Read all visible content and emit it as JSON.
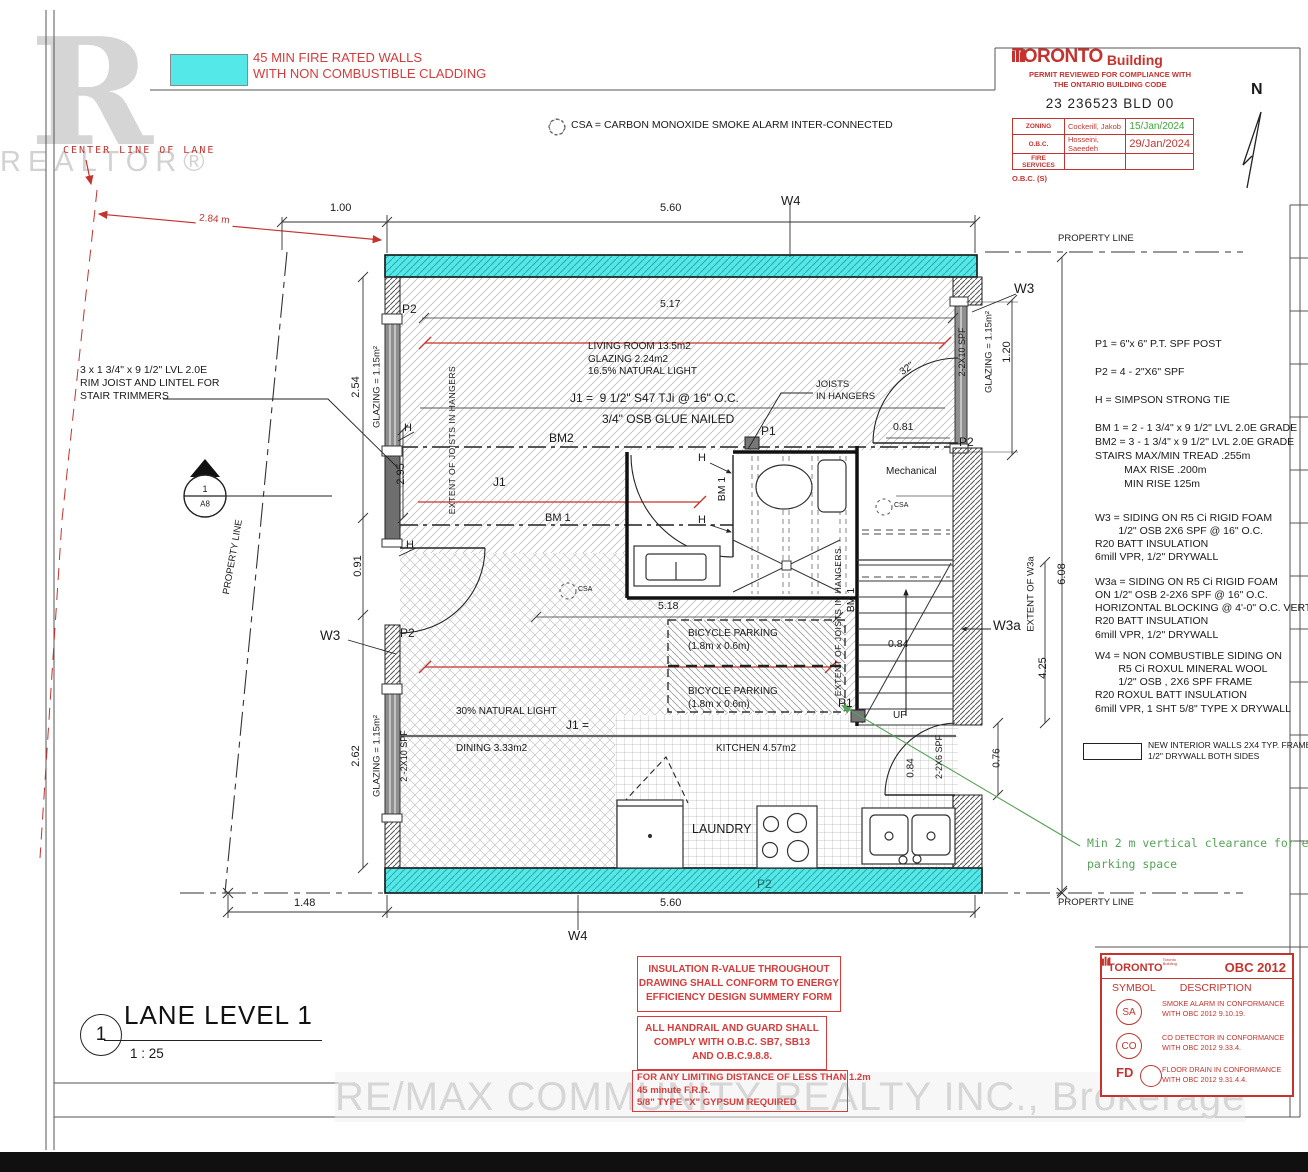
{
  "colors": {
    "fire_wall_cyan": "#55e8e8",
    "permit_red": "#c5332f",
    "note_red": "#d63c3c",
    "date_green": "#3aa83a",
    "annot_green": "#55a357"
  },
  "watermark": {
    "r": "R",
    "realtor": "REALTOR®",
    "brokerage": "RE/MAX COMMUNITY REALTY INC., Brokerage"
  },
  "fire_legend": "45 MIN FIRE RATED WALLS\nWITH NON COMBUSTIBLE CLADDING",
  "lane_centerline": "CENTER LINE OF LANE",
  "csa_note": "CSA = CARBON MONOXIDE SMOKE ALARM INTER-CONNECTED",
  "north_label": "N",
  "stamp": {
    "brand_toronto": "TORONTO",
    "brand_building": "Building",
    "subtitle": "PERMIT REVIEWED FOR COMPLIANCE WITH\nTHE ONTARIO BUILDING CODE",
    "permit_no": "23 236523 BLD 00",
    "rows": [
      {
        "label": "ZONING",
        "name": "Cockerill, Jakob",
        "date": "15/Jan/2024"
      },
      {
        "label": "O.B.C.",
        "name": "Hosseini, Saeedeh",
        "date": "29/Jan/2024"
      },
      {
        "label": "FIRE SERVICES",
        "name": "",
        "date": ""
      }
    ],
    "footer": "O.B.C. (S)"
  },
  "side_notes": {
    "posts": "P1 = 6\"x 6\" P.T. SPF POST\n\nP2 = 4 - 2\"X6\" SPF\n\nH = SIMPSON STRONG TIE\n\nBM 1 = 2 - 1 3/4\" x 9 1/2\" LVL 2.0E GRADE\nBM2 = 3 - 1 3/4\" x 9 1/2\" LVL 2.0E GRADE\nSTAIRS MAX/MIN TREAD .255m\n          MAX RISE .200m\n          MIN RISE 125m",
    "w3": "W3 = SIDING ON R5 Ci RIGID FOAM\n        1/2\" OSB 2X6 SPF @ 16\" O.C.\nR20 BATT INSULATION\n6mill VPR, 1/2\" DRYWALL",
    "w3a": "W3a = SIDING ON R5 Ci RIGID FOAM\nON 1/2\" OSB 2-2X6 SPF @ 16\" O.C.\nHORIZONTAL BLOCKING @ 4'-0\" O.C. VERTICAL\nR20 BATT INSULATION\n6mill VPR, 1/2\" DRYWALL",
    "w4": "W4 = NON COMBUSTIBLE SIDING ON\n        R5 Ci ROXUL MINERAL WOOL\n        1/2\" OSB , 2X6 SPF FRAME\nR20 ROXUL BATT INSULATION\n6mill VPR, 1 SHT 5/8\" TYPE X DRYWALL",
    "interior_walls": "NEW INTERIOR WALLS 2X4 TYP. FRAME\n1/2\" DRYWALL BOTH SIDES",
    "rim_joist": "3 x 1 3/4\" x 9 1/2\" LVL 2.0E\nRIM JOIST AND LINTEL FOR\nSTAIR TRIMMERS"
  },
  "rooms": {
    "living": "LIVING ROOM 13.5m2\nGLAZING 2.24m2\n16.5% NATURAL LIGHT",
    "mechanical": "Mechanical",
    "bicycle": "BICYCLE PARKING\n(1.8m x 0.6m)",
    "dining": "DINING 3.33m2",
    "kitchen": "KITCHEN 4.57m2",
    "laundry": "LAUNDRY",
    "natural_light": "30% NATURAL LIGHT",
    "up": "UP"
  },
  "structure": {
    "j1_spec": "J1 =  9 1/2\" S47 TJi @ 16\" O.C.",
    "osb": "3/4\" OSB GLUE NAILED",
    "bm2": "BM2",
    "bm1": "BM 1",
    "j1": "J1",
    "j1_eq": "J1 =",
    "joists_in_hangers": "JOISTS\nIN HANGERS",
    "extent_joists": "EXTENT OF JOISTS IN HANGERS",
    "extent_w3a": "EXTENT OF W3a",
    "csa": "CSA",
    "p1": "P1",
    "p2": "P2",
    "h": "H",
    "w3": "W3",
    "w3a": "W3a",
    "w4": "W4",
    "spf_2x10": "2-2X10 SPF",
    "spf_2x10_sp": "2 -2X10 SPF",
    "spf_2x6": "2-2X6 SPF",
    "door_32": "32\""
  },
  "dims": {
    "d100": "1.00",
    "d560": "5.60",
    "d284": "2.84 m",
    "d517": "5.17",
    "d518": "5.18",
    "d254": "2.54",
    "d295": "2.95",
    "d091": "0.91",
    "d262": "2.62",
    "d148": "1.48",
    "d081": "0.81",
    "d084": "0.84",
    "d120": "1.20",
    "d425": "4.25",
    "d608": "6.08",
    "d076": "0.76",
    "glazing": "GLAZING = 1.15m²"
  },
  "boundaries": {
    "property_line": "PROPERTY LINE"
  },
  "section_marker": {
    "num": "1",
    "sheet": "A8"
  },
  "green_note": "Min 2 m vertical clearance for each\nparking space",
  "red_notes": {
    "insulation": "INSULATION R-VALUE THROUGHOUT\nDRAWING SHALL CONFORM TO ENERGY\nEFFICIENCY DESIGN SUMMERY FORM",
    "handrail": "ALL HANDRAIL AND GUARD SHALL\nCOMPLY WITH O.B.C. SB7, SB13\nAND O.B.C.9.8.8.",
    "limiting": "FOR ANY LIMITING DISTANCE OF LESS THAN 1.2m\n45 minute F.R.R.\n5/8\" TYPE \"X\" GYPS­UM REQUIRED"
  },
  "obc_legend": {
    "brand": "TORONTO",
    "brand_sub": "Toronto\nBuilding",
    "title": "OBC 2012",
    "col_symbol": "SYMBOL",
    "col_desc": "DESCRIPTION",
    "rows": [
      {
        "symbol": "SA",
        "desc": "SMOKE ALARM IN CONFORMANCE\nWITH OBC 2012 9.10.19."
      },
      {
        "symbol": "CO",
        "desc": "CO DETECTOR IN CONFORMANCE\nWITH OBC 2012 9.33.4."
      },
      {
        "symbol": "FD",
        "desc": "FLOOR DRAIN IN CONFORMANCE\nWITH OBC 2012 9.31.4.4."
      }
    ]
  },
  "title_block": {
    "num": "1",
    "title": "LANE LEVEL 1",
    "scale": "1 : 25"
  }
}
